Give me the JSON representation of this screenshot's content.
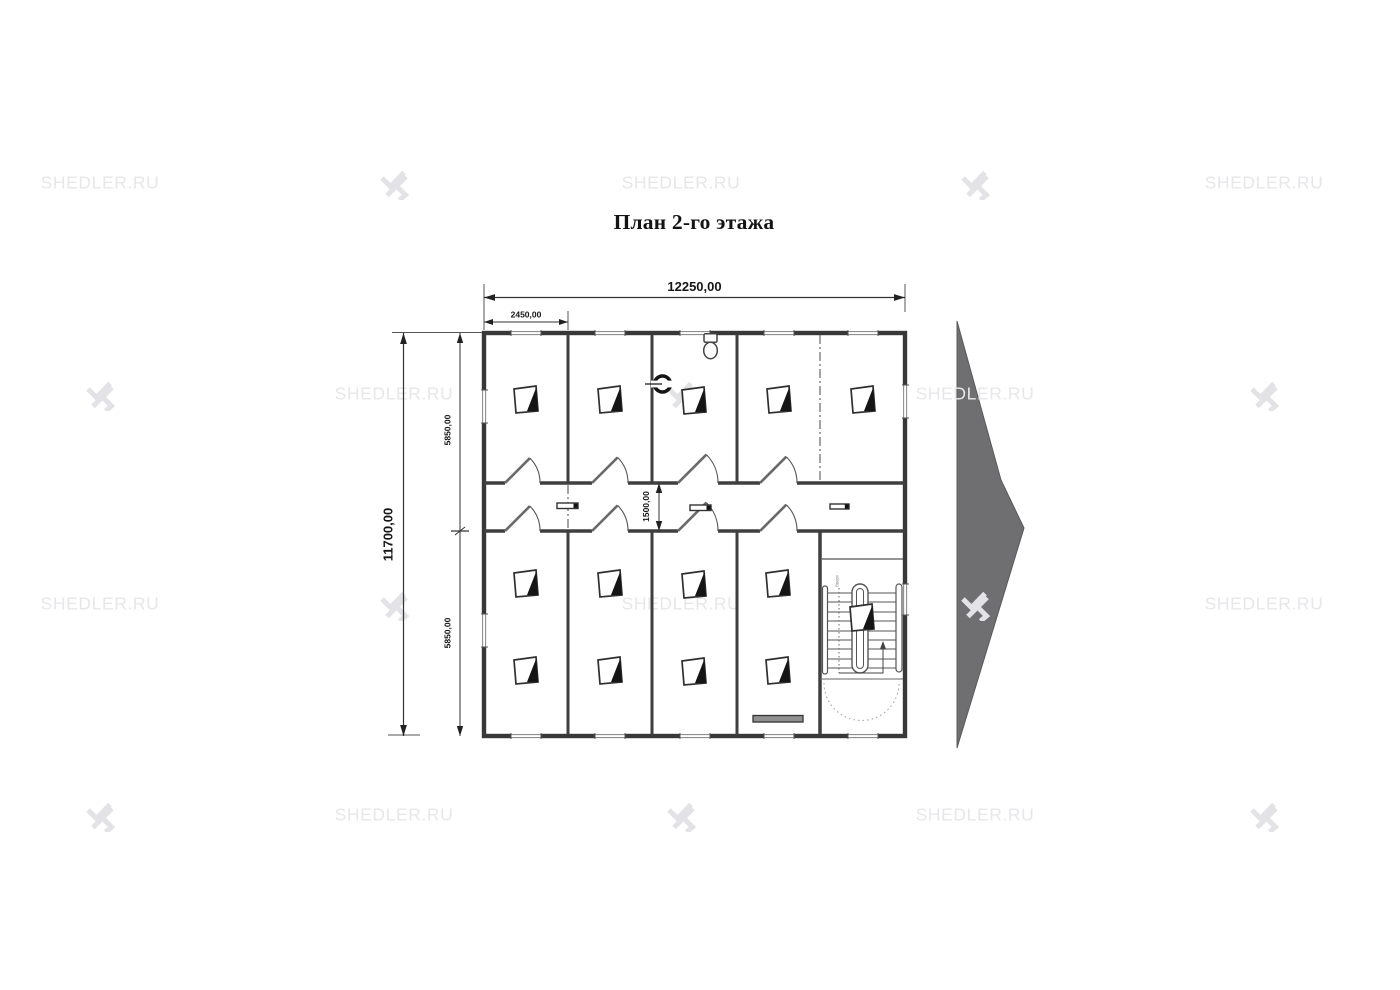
{
  "title": "План 2-го этажа",
  "watermark": {
    "text": "SHEDLER.RU"
  },
  "dimensions": {
    "overall_width": "12250,00",
    "bay_width": "2450,00",
    "overall_depth": "11700,00",
    "top_rooms_depth": "5850,00",
    "bottom_rooms_depth": "5850,00",
    "corridor_width": "1500,00"
  },
  "stairs": {
    "direction_label": "Вверх"
  },
  "colors": {
    "wall": "#383838",
    "window": "#8f8f8f",
    "watermark": "#e7e7ea",
    "next_arrow": "#6f6f71",
    "dimension_text": "#161616"
  }
}
